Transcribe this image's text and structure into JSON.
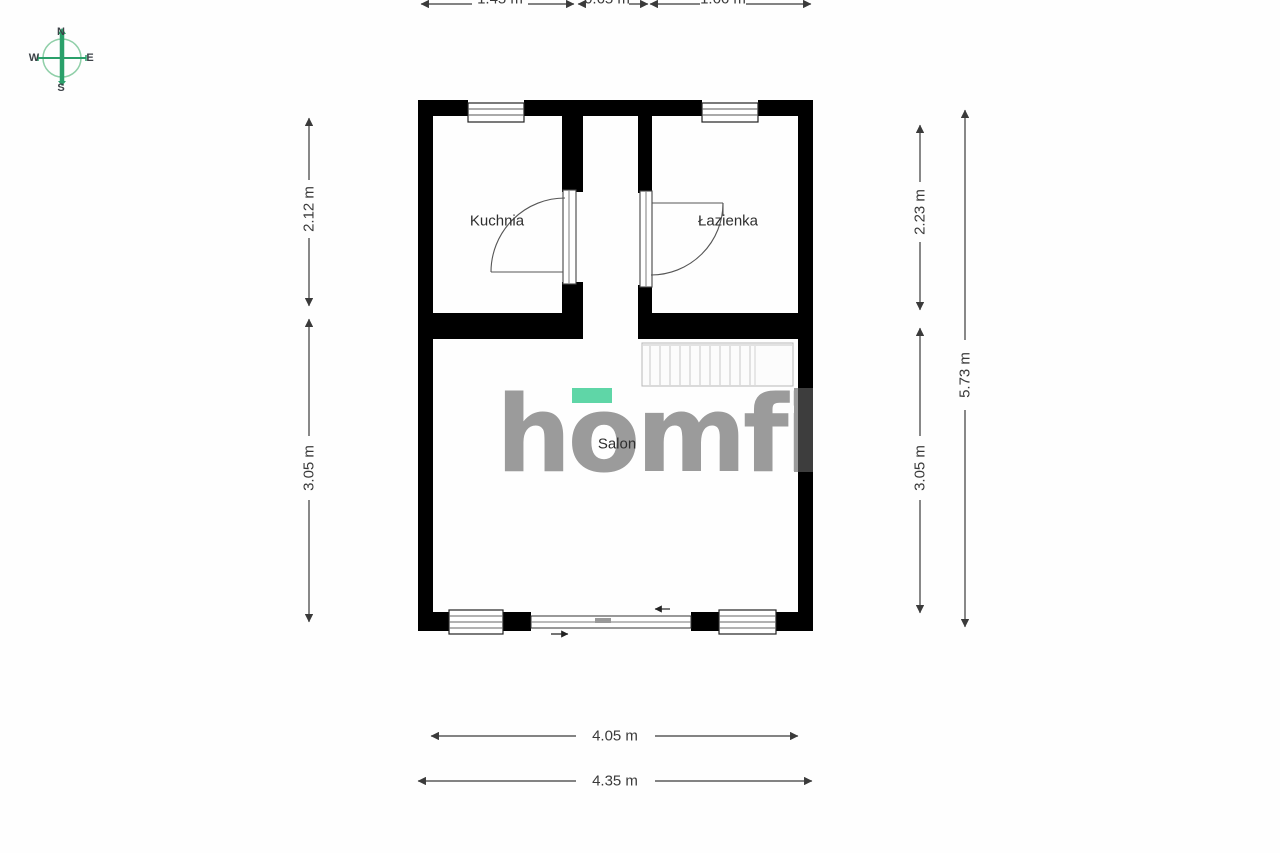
{
  "compass": {
    "north": "N",
    "south": "S",
    "east": "E",
    "west": "W"
  },
  "rooms": {
    "kitchen": "Kuchnia",
    "bathroom": "Łazienka",
    "living": "Salon"
  },
  "dimensions": {
    "top": [
      {
        "label": "1.45 m"
      },
      {
        "label": "0.65 m"
      },
      {
        "label": "1.66 m"
      }
    ],
    "left": [
      {
        "label": "2.12 m"
      },
      {
        "label": "3.05 m"
      }
    ],
    "right": [
      {
        "label": "2.23 m"
      },
      {
        "label": "3.05 m"
      },
      {
        "label": "5.73 m"
      }
    ],
    "bottom": [
      {
        "label": "4.05 m"
      },
      {
        "label": "4.35 m"
      }
    ]
  },
  "watermark": {
    "brand": "homfi",
    "accent_color": "#5fd6a7",
    "text_color": "#9b9b9b"
  },
  "colors": {
    "wall": "#000000",
    "compass_green": "#2aa06a",
    "dimension": "#3a3a3a"
  }
}
